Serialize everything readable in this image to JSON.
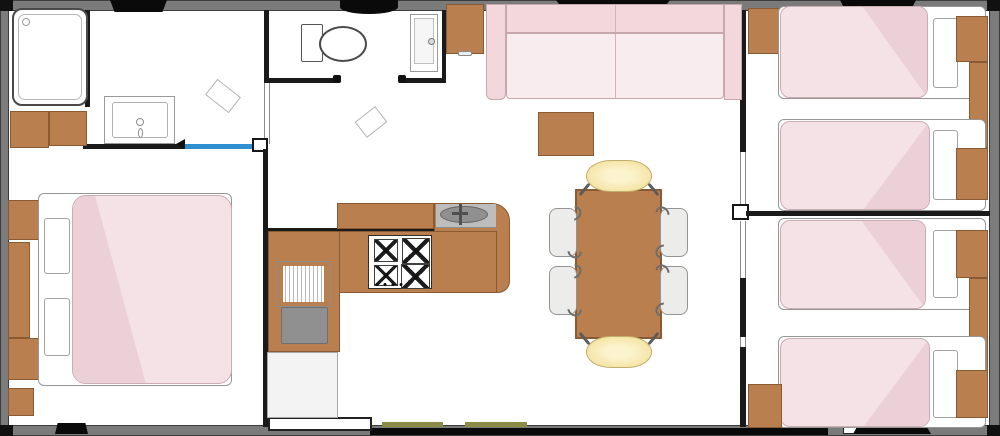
{
  "meta": {
    "type": "floor-plan",
    "description": "Top-down mobile-home floor plan with three bedrooms, bathroom, WC, kitchen and living-dining area",
    "visible_text": []
  },
  "colors": {
    "wall_grey": "#7b7b7b",
    "wall_dark": "#1a1a1a",
    "wood": "#b97f4f",
    "wood_border": "#8a5a33",
    "pink_soft": "#f5e2e6",
    "pink_mid": "#f2d7dc",
    "pink_deep": "#ecd0d8",
    "yellow_chair": "#f5e4a4",
    "grey_chair": "#ececea",
    "blue_door": "#2e8fd2",
    "olive_step": "#8b8b45",
    "grey_appliance": "#909090",
    "white_fixture": "#ffffff"
  },
  "rooms": [
    {
      "id": "bathroom",
      "features": [
        "shower",
        "washbasin",
        "cabinets",
        "sliding-door-blue"
      ]
    },
    {
      "id": "wc",
      "features": [
        "toilet",
        "basin-column",
        "cabinet"
      ]
    },
    {
      "id": "master-bedroom",
      "features": [
        "double-bed",
        "nightstands",
        "dresser"
      ]
    },
    {
      "id": "kitchen",
      "features": [
        "gas-hob-4-burners",
        "sink",
        "counter-L",
        "fridge",
        "grill-appliance"
      ]
    },
    {
      "id": "living-dining",
      "features": [
        "sofa-2-seats",
        "coffee-table",
        "dining-table",
        "4-chairs",
        "2-benches"
      ]
    },
    {
      "id": "twin-bedroom-top",
      "features": [
        "2-single-beds",
        "wardrobe",
        "nightstands",
        "cabinet"
      ]
    },
    {
      "id": "twin-bedroom-bottom",
      "features": [
        "2-single-beds",
        "wardrobe",
        "nightstands",
        "cabinet"
      ]
    }
  ],
  "furniture_counts": {
    "double_beds": 1,
    "single_beds": 4,
    "dining_chairs": 4,
    "dining_benches": 2,
    "stove_burners": 4,
    "windows_top": 3,
    "windows_bottom": 2
  }
}
